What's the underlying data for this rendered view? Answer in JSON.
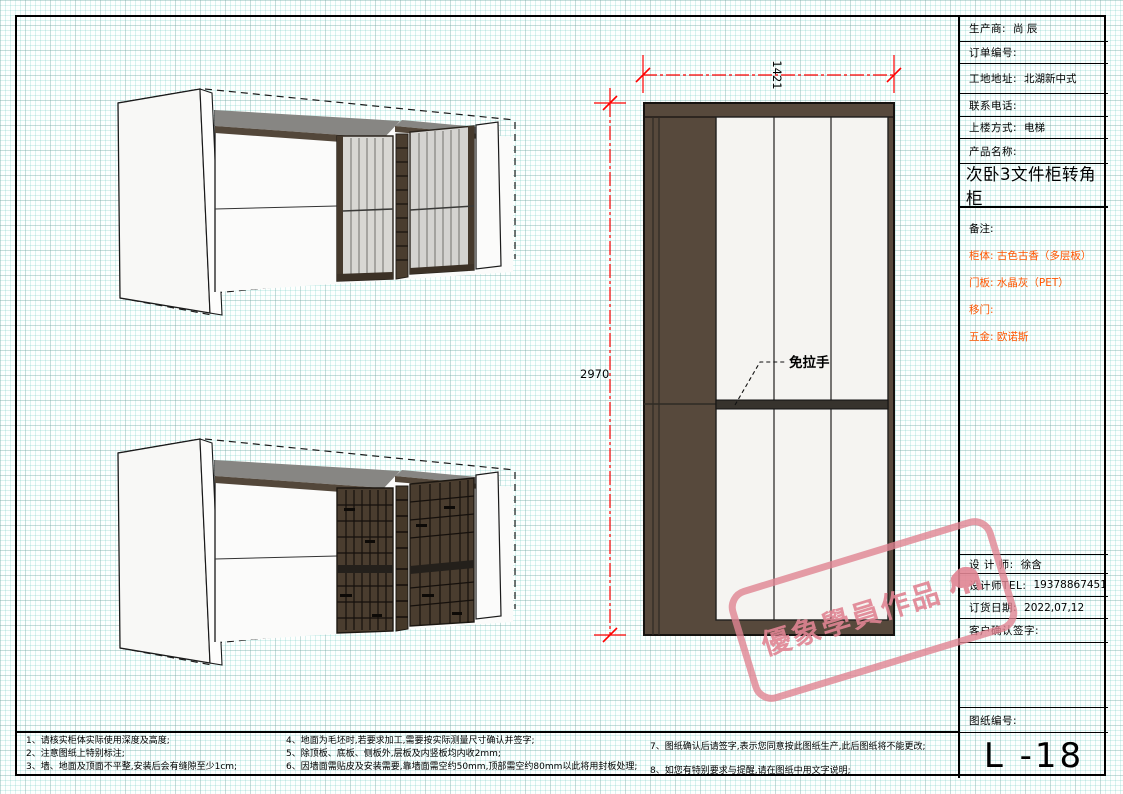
{
  "title_block": {
    "rows": [
      {
        "label": "生产商:",
        "value": "尚 辰"
      },
      {
        "label": "订单编号:",
        "value": ""
      },
      {
        "label": "工地地址:",
        "value": "北湖新中式"
      },
      {
        "label": "联系电话:",
        "value": ""
      },
      {
        "label": "上楼方式:",
        "value": "电梯"
      },
      {
        "label": "产品名称:",
        "value": ""
      }
    ],
    "product_name_large": "次卧3文件柜转角柜",
    "remarks_label": "备注:",
    "remarks": [
      {
        "label": "柜体:",
        "value": "古色古香（多层板）"
      },
      {
        "label": "门板:",
        "value": "水晶灰（PET）"
      },
      {
        "label": "移门:",
        "value": ""
      },
      {
        "label": "五金:",
        "value": "欧诺斯"
      }
    ],
    "designer_label": "设 计 师:",
    "designer": "徐含",
    "designer_tel_label": "设计师TEL:",
    "designer_tel": "19378867451",
    "order_date_label": "订货日期:",
    "order_date": "2022,07,12",
    "customer_sign_label": "客户确认签字:",
    "drawing_no_label": "图纸编号:",
    "drawing_no": "L -18"
  },
  "drawing": {
    "dim_width": "1421",
    "dim_height": "2970",
    "annotation_no_handle": "免拉手"
  },
  "notes": {
    "col1": [
      "1、请核实柜体实际使用深度及高度;",
      "2、注意图纸上特别标注;",
      "3、墙、地面及顶面不平整,安装后会有缝隙至少1cm;"
    ],
    "col2": [
      "4、地面为毛坯时,若要求加工,需要按实际测量尺寸确认并签字;",
      "5、除顶板、底板、侧板外,层板及内竖板均内收2mm;",
      "6、因墙面需贴皮及安装需要,靠墙面需空约50mm,顶部需空约80mm以此将用封板处理;"
    ],
    "col3": [
      "7、图纸确认后请签字,表示您同意按此图纸生产,此后图纸将不能更改;",
      "8、如您有特别要求与提醒,请在图纸中用文字说明;"
    ]
  },
  "watermark": {
    "text": "優象學員作品"
  },
  "colors": {
    "dimension_red": "#ff0000",
    "cabinet_brown": "#57493c",
    "dark_rail": "#37332d",
    "remark_orange": "#ff5500",
    "watermark_pink": "#e08492",
    "glass_gray": "#d8d7d3",
    "shelf_brown": "#4a3d2f"
  }
}
